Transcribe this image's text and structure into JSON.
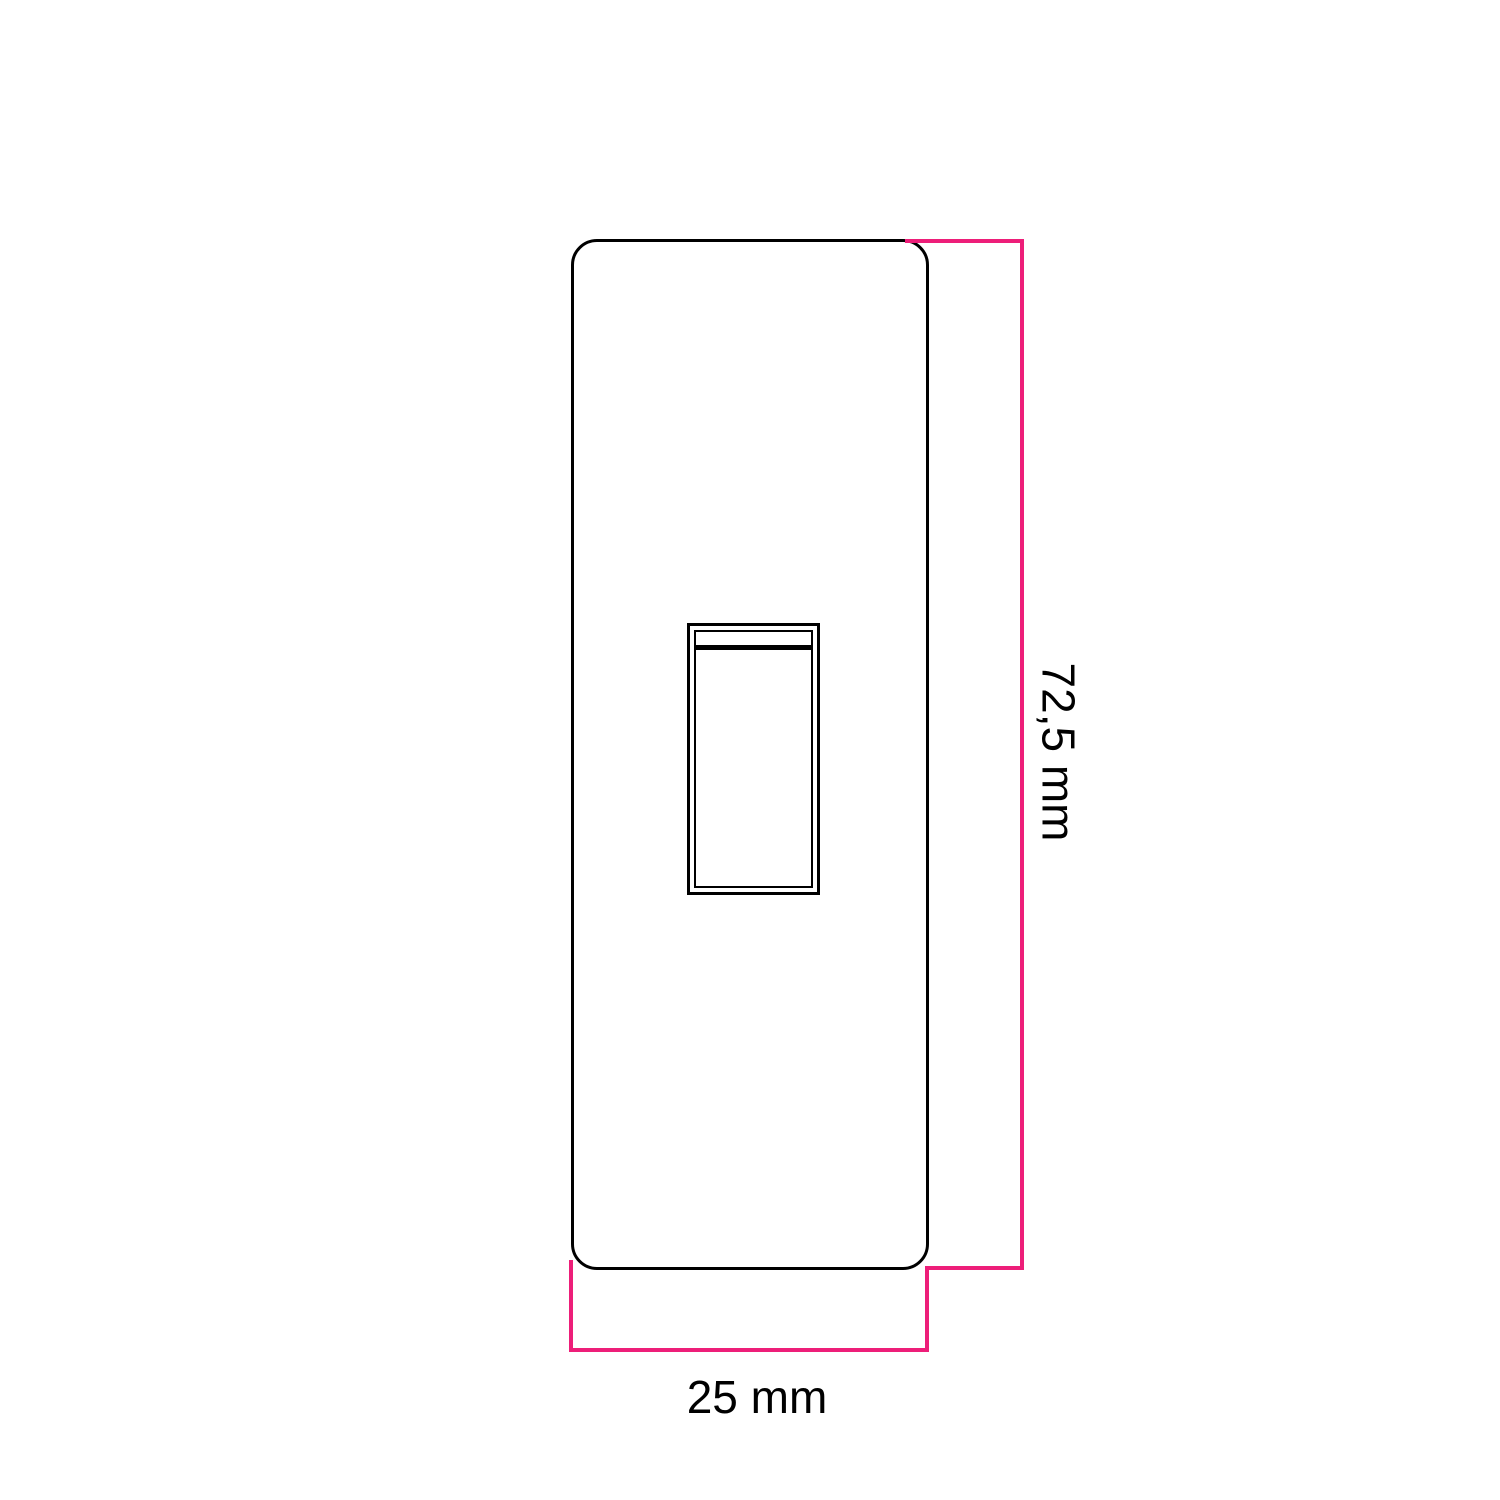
{
  "drawing": {
    "type": "technical-dimension-diagram",
    "part": "switch-faceplate-front-view",
    "dimensions": {
      "height_label": "72,5 mm",
      "width_label": "25 mm"
    },
    "colors": {
      "dimension_line": "#ED1E79",
      "outline": "#000000",
      "background": "#FFFFFF",
      "label_text": "#000000"
    }
  }
}
